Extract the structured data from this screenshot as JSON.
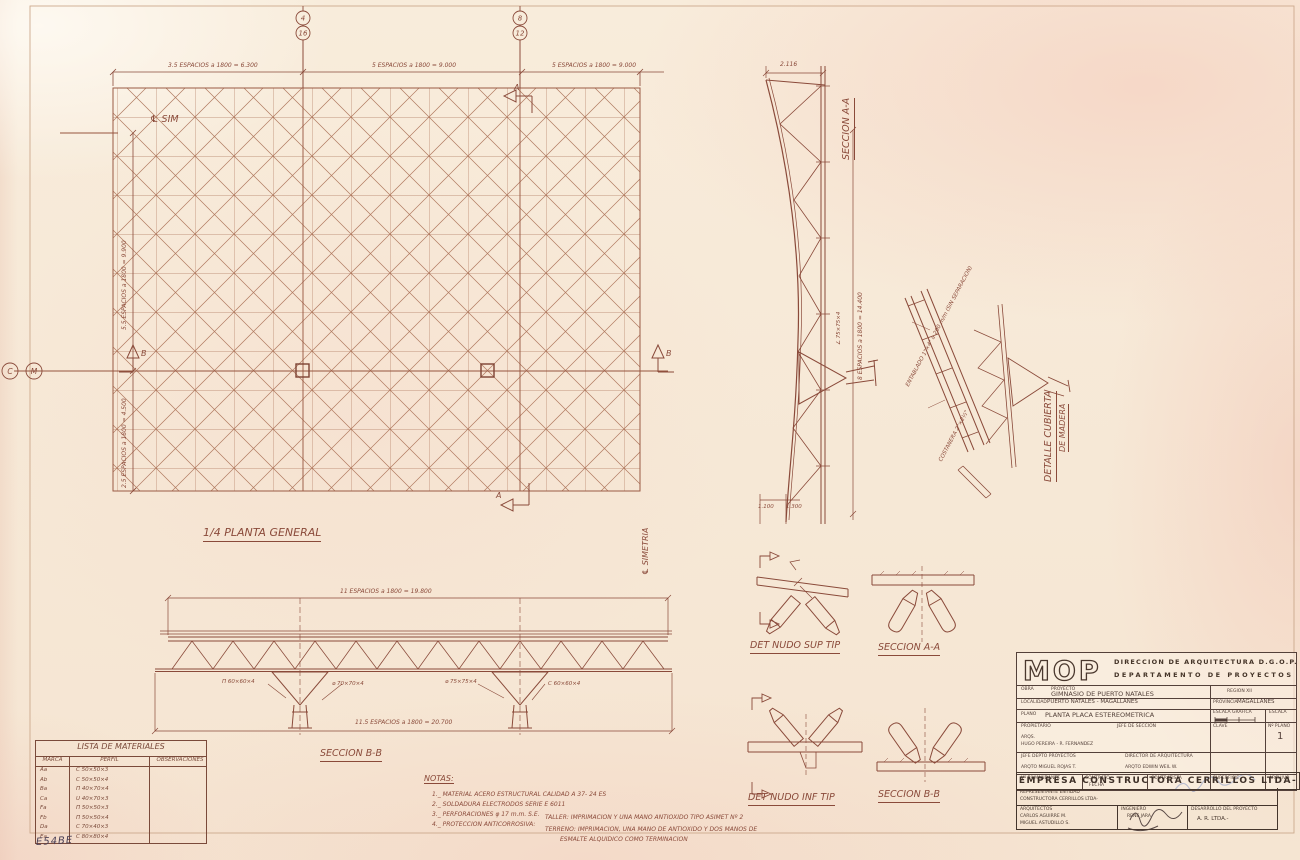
{
  "colors": {
    "ink": "#8a4a3a",
    "paper": "#f7ead8",
    "signature_blue": "#6d7fb5"
  },
  "plan": {
    "title": "1/4 PLANTA GENERAL",
    "centerline_top": "℄ SIM",
    "centerline_right": "℄ SIMETRIA",
    "dim_top_1": "3.5 ESPACIOS a 1800 = 6.300",
    "dim_top_2": "5 ESPACIOS a 1800 = 9.000",
    "dim_top_3": "5 ESPACIOS a 1800 = 9.000",
    "dim_left_1": "5.5 ESPACIOS a 1800 = 9.900",
    "dim_left_2": "2.5 ESPACIOS a 1800 = 4.500",
    "bubbles": {
      "b4": "4",
      "b16": "16",
      "b8": "8",
      "b12": "12",
      "bc": "C",
      "bm": "M"
    },
    "arrow_a": "A",
    "arrow_b": "B"
  },
  "seccion_bb": {
    "title": "SECCION B-B",
    "dim_top": "11 ESPACIOS a 1800 = 19.800",
    "dim_bottom": "11.5 ESPACIOS a 1800 = 20.700",
    "label_1": "Π 60×60×4",
    "label_2": "⌀ 70×70×4",
    "label_3": "⌀ 75×75×4",
    "label_4": "C 60×60×4"
  },
  "seccion_aa": {
    "title": "SECCION A-A",
    "dim_top": "2.116",
    "dim_right": "8 ESPACIOS a 1800 = 14.400",
    "label_1": "∠ 75×75×4",
    "dim_bottom_1": "1.100",
    "dim_bottom_2": "1.300"
  },
  "cubierta": {
    "title_line1": "DETALLE CUBIERTA",
    "title_line2": "DE MADERA",
    "label_1": "ENTABLADO 1\"×4\" a 200 m/m (SIN SEPARACION)",
    "label_2": "COSTANERA 2\"×2½\""
  },
  "nodos": {
    "sup_title": "DET NUDO SUP TIP",
    "sup_section": "SECCION A-A",
    "inf_title": "DET NUDO INF TIP",
    "inf_section": "SECCION B-B"
  },
  "materiales": {
    "title": "LISTA DE MATERIALES",
    "headers": [
      "MARCA",
      "PERFIL",
      "OBSERVACIONES"
    ],
    "rows": [
      {
        "marca": "Aa",
        "perfil": "C 50×50×3",
        "obs": ""
      },
      {
        "marca": "Ab",
        "perfil": "C 50×50×4",
        "obs": ""
      },
      {
        "marca": "Ba",
        "perfil": "Π 40×70×4",
        "obs": ""
      },
      {
        "marca": "Ca",
        "perfil": "U 40×70×3",
        "obs": ""
      },
      {
        "marca": "Fa",
        "perfil": "Π 50×50×3",
        "obs": ""
      },
      {
        "marca": "Fb",
        "perfil": "Π 50×50×4",
        "obs": ""
      },
      {
        "marca": "Da",
        "perfil": "C 70×40×3",
        "obs": ""
      },
      {
        "marca": "Ea",
        "perfil": "C 80×80×4",
        "obs": ""
      }
    ]
  },
  "notas": {
    "title": "NOTAS:",
    "item_1": "1._ MATERIAL ACERO ESTRUCTURAL CALIDAD A 37- 24 ES",
    "item_2": "2._ SOLDADURA ELECTRODOS SERIE E 6011",
    "item_3": "3._ PERFORACIONES φ 17 m.m. S.E.",
    "item_4": "4._ PROTECCION ANTICORROSIVA:",
    "taller": "TALLER: IMPRIMACION Y UNA MANO ANTIOXIDO TIPO ASIMET Nº 2",
    "terreno_1": "TERRENO: IMPRIMACION, UNA MANO DE ANTIOXIDO Y DOS MANOS DE",
    "terreno_2": "ESMALTE ALQUIDICO COMO TERMINACION"
  },
  "titleblock": {
    "logo": "MOP",
    "org_line1": "DIRECCION DE ARQUITECTURA D.G.O.P.",
    "org_line2": "DEPARTAMENTO DE PROYECTOS",
    "obra_label": "OBRA",
    "proyecto_label": "PROYECTO",
    "obra_value": "GIMNASIO DE PUERTO NATALES",
    "region_value": "REGION XII",
    "localidad_label": "LOCALIDAD",
    "localidad_value": "PUERTO NATALES - MAGALLANES",
    "provincia_label": "PROVINCIA",
    "provincia_value": "MAGALLANES",
    "plano_label": "PLANO",
    "plano_value": "PLANTA PLACA ESTEREOMETRICA",
    "escala_grafica_label": "ESCALA GRAFICA",
    "escala_label": "ESCALA",
    "propietario_label": "PROPIETARIO",
    "jefe_seccion_label": "JEFE DE SECCION",
    "arqs_line1": "ARQS.",
    "arqs_line2": "HUGO PEREIRA - R. FERNANDEZ",
    "clave_label": "CLAVE",
    "num_plano_label": "Nº PLANO",
    "num_plano_value": "1",
    "jefe_depto_label": "JEFE DEPTO PROYECTOS",
    "director_label": "DIRECTOR DE ARQUITECTURA",
    "arqto_1": "ARQTO MIGUEL ROJAS T.",
    "arqto_2": "ARQTO EDWIN WEIL W.",
    "vb_mandante_label": "Vº Bº MANDANTE",
    "contrato_label": "CONTRATO",
    "fecha_label": "FECHA",
    "contratista_label": "CONTRATISTA",
    "superficie_label": "SUPERFICIE",
    "archivo_label": "ARCHIVO"
  },
  "empresa": {
    "nombre": "EMPRESA CONSTRUCTORA CERRILLOS LTDA-",
    "representante_label": "REPRESENTANTE ENTIDAD",
    "representante_value": "CONSTRUCTORA CERRILLOS LTDA-",
    "arquitectos_label": "ARQUITECTOS",
    "arquitecto_1": "CARLOS AGUIRRE M.",
    "arquitecto_2": "MIGUEL ASTUDILLO S.",
    "ingeniero_label": "INGENIERO",
    "ingeniero_value": "RENE JARA",
    "desarrollo_label": "DESARROLLO DEL PROYECTO",
    "desarrollo_value": "A. R. LTDA.-"
  },
  "handwritten_code": "E54BE"
}
